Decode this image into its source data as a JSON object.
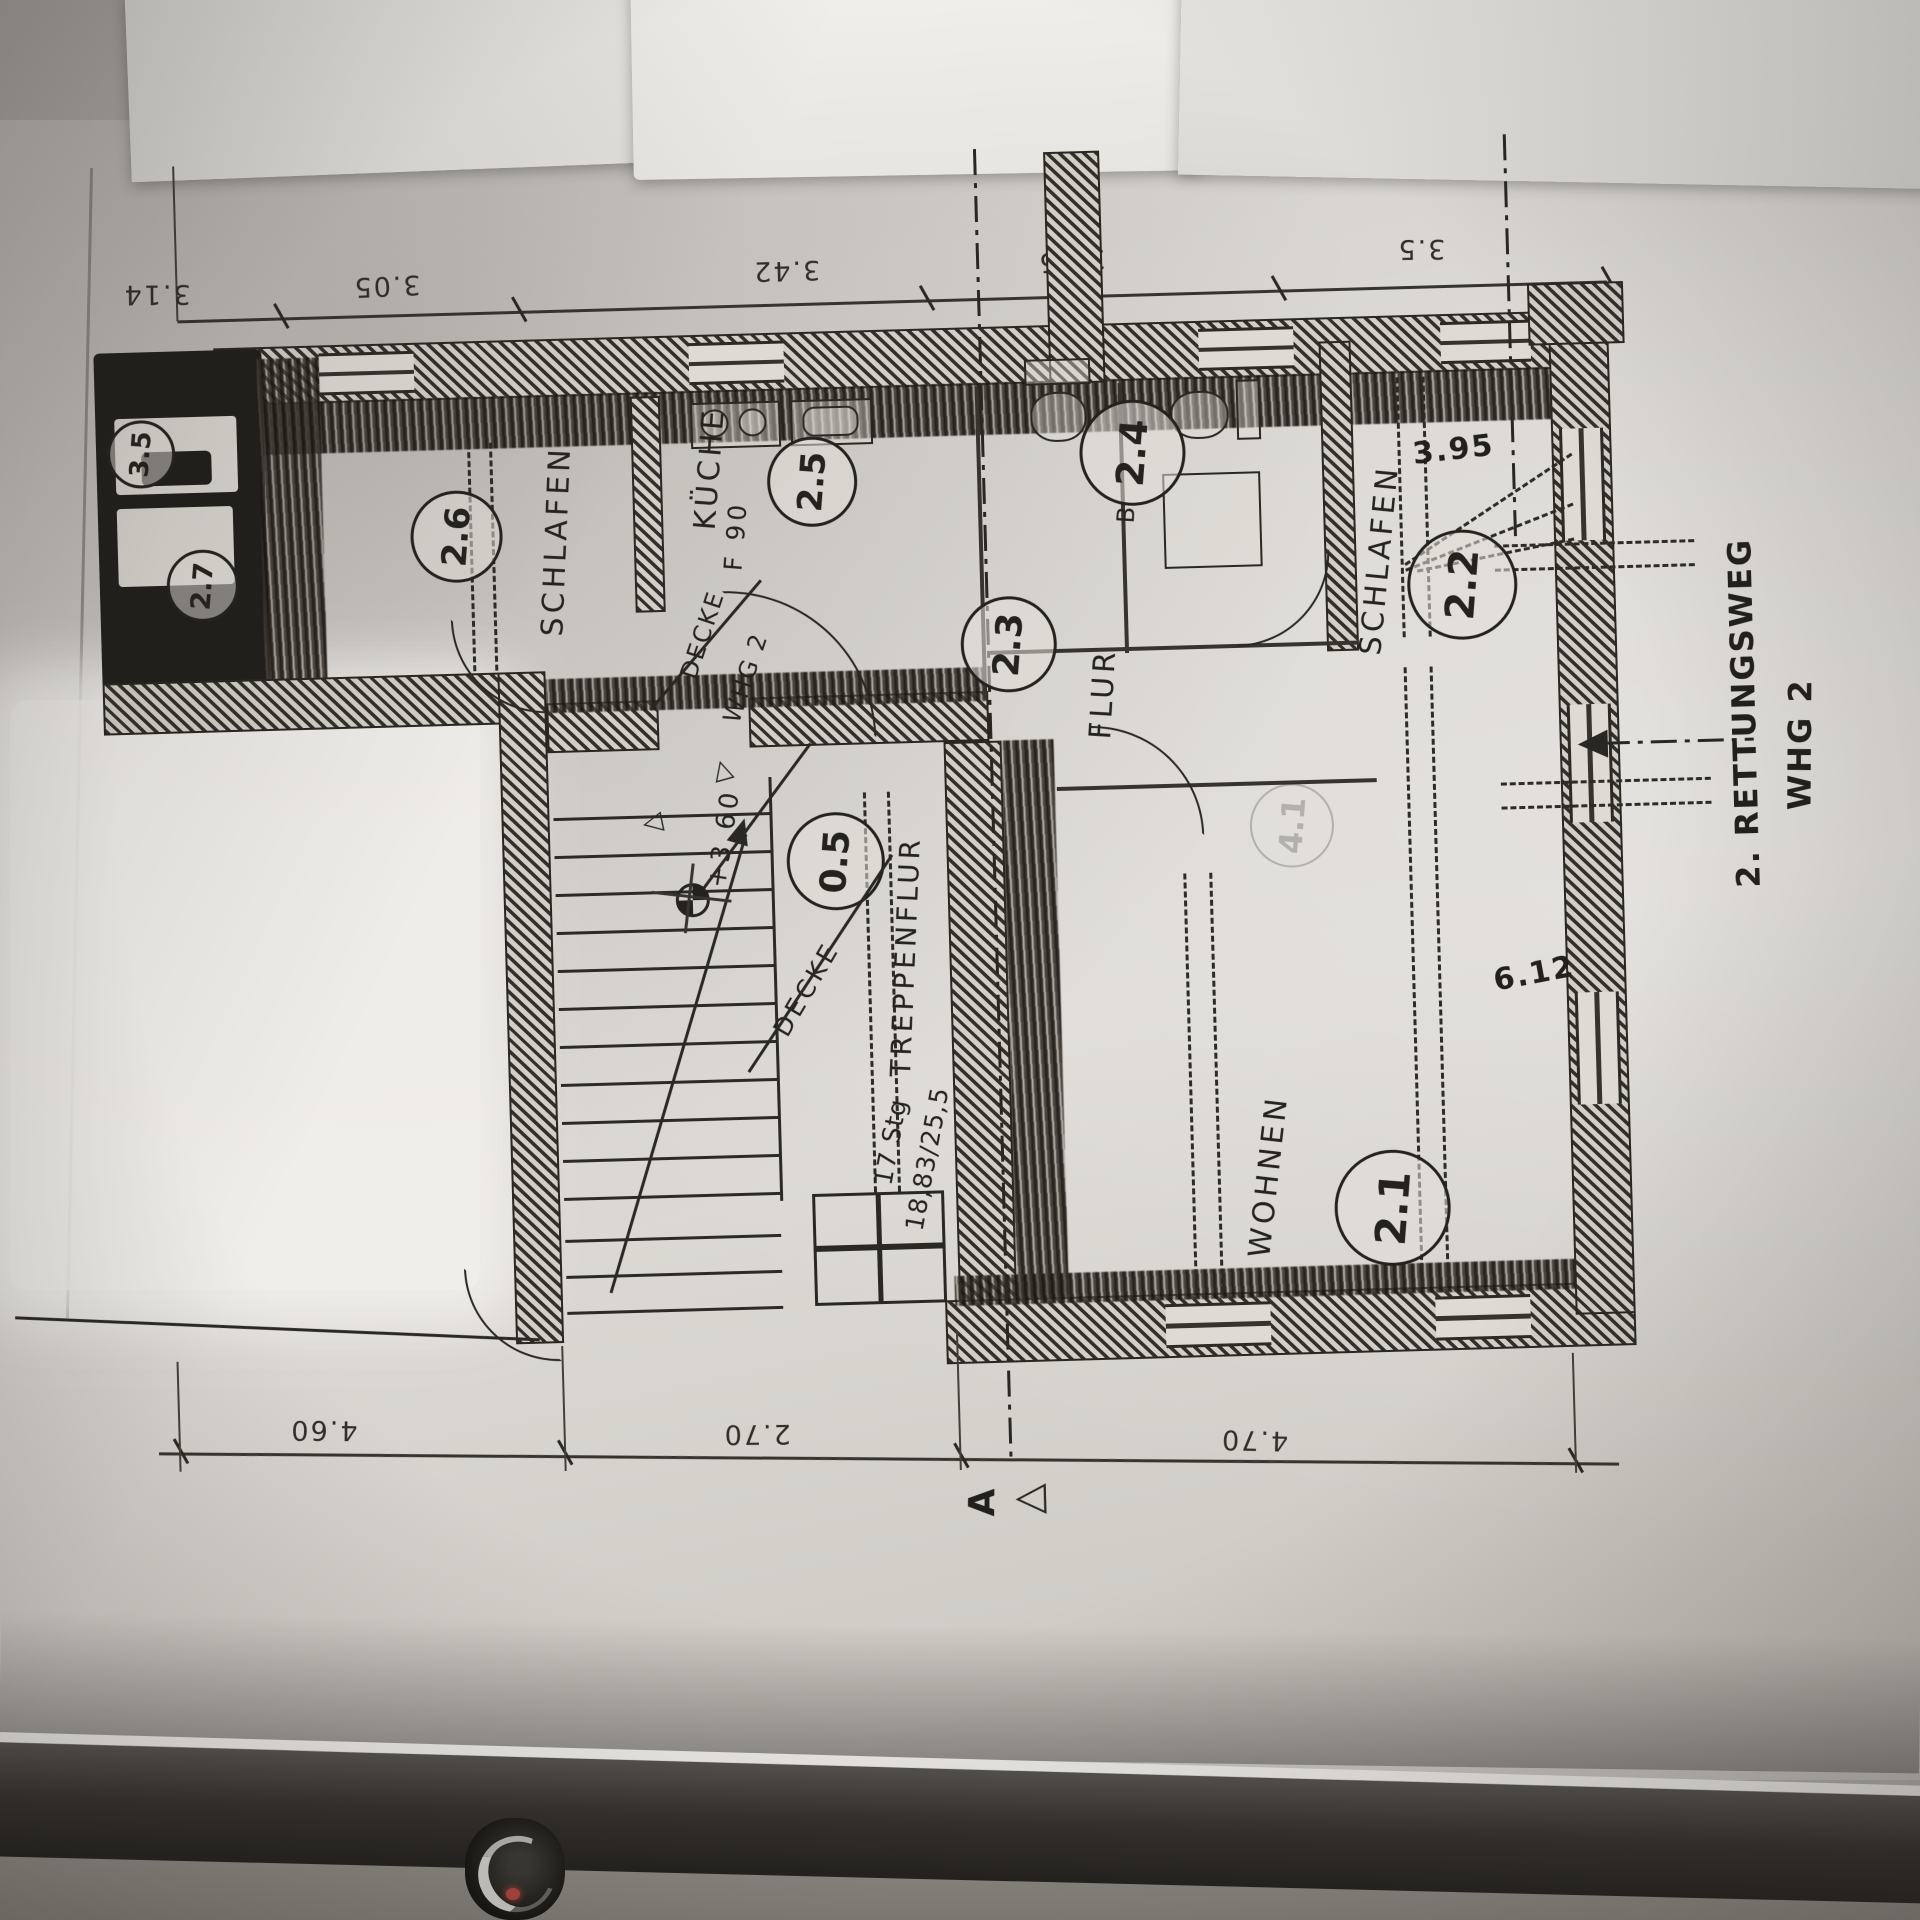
{
  "plan": {
    "dimensions": {
      "top": [
        "3.14",
        "3.05",
        "3.42",
        "2.35",
        "3.5"
      ],
      "bottom": [
        "4.60",
        "2.70",
        "4.70"
      ],
      "right_width": "3.95",
      "right_length": "6.12"
    },
    "rooms": {
      "wohnen": {
        "id": "2.1",
        "name": "WOHNEN"
      },
      "schlafen_right": {
        "id": "2.2",
        "name": "SCHLAFEN"
      },
      "flur": {
        "id": "2.3",
        "name": "FLUR"
      },
      "bad": {
        "id": "2.4",
        "name": "B"
      },
      "kueche": {
        "id": "2.5",
        "name": "KÜCHE",
        "fire_rating": "F 90"
      },
      "schlafen_left": {
        "id": "2.6",
        "name": "SCHLAFEN"
      },
      "abstell": {
        "id": "2.7"
      },
      "wc_left": {
        "id": "3.5"
      },
      "treppenflur": {
        "id": "0.5",
        "name": "TREPPENFLUR"
      },
      "faint": {
        "id": "4.1"
      }
    },
    "stairs": {
      "count": "17 Stg",
      "ratio": "18,83/25,5"
    },
    "levels": {
      "height": "+3.60",
      "decke": "DECKE",
      "decke_whg_line1": "DECKE",
      "decke_whg_line2": "WHG 2"
    },
    "annotations": {
      "rescue_line1": "2. RETTUNGSWEG",
      "rescue_line2": "WHG 2",
      "section_marker": "A"
    },
    "icons": {
      "triangle": "△"
    }
  }
}
